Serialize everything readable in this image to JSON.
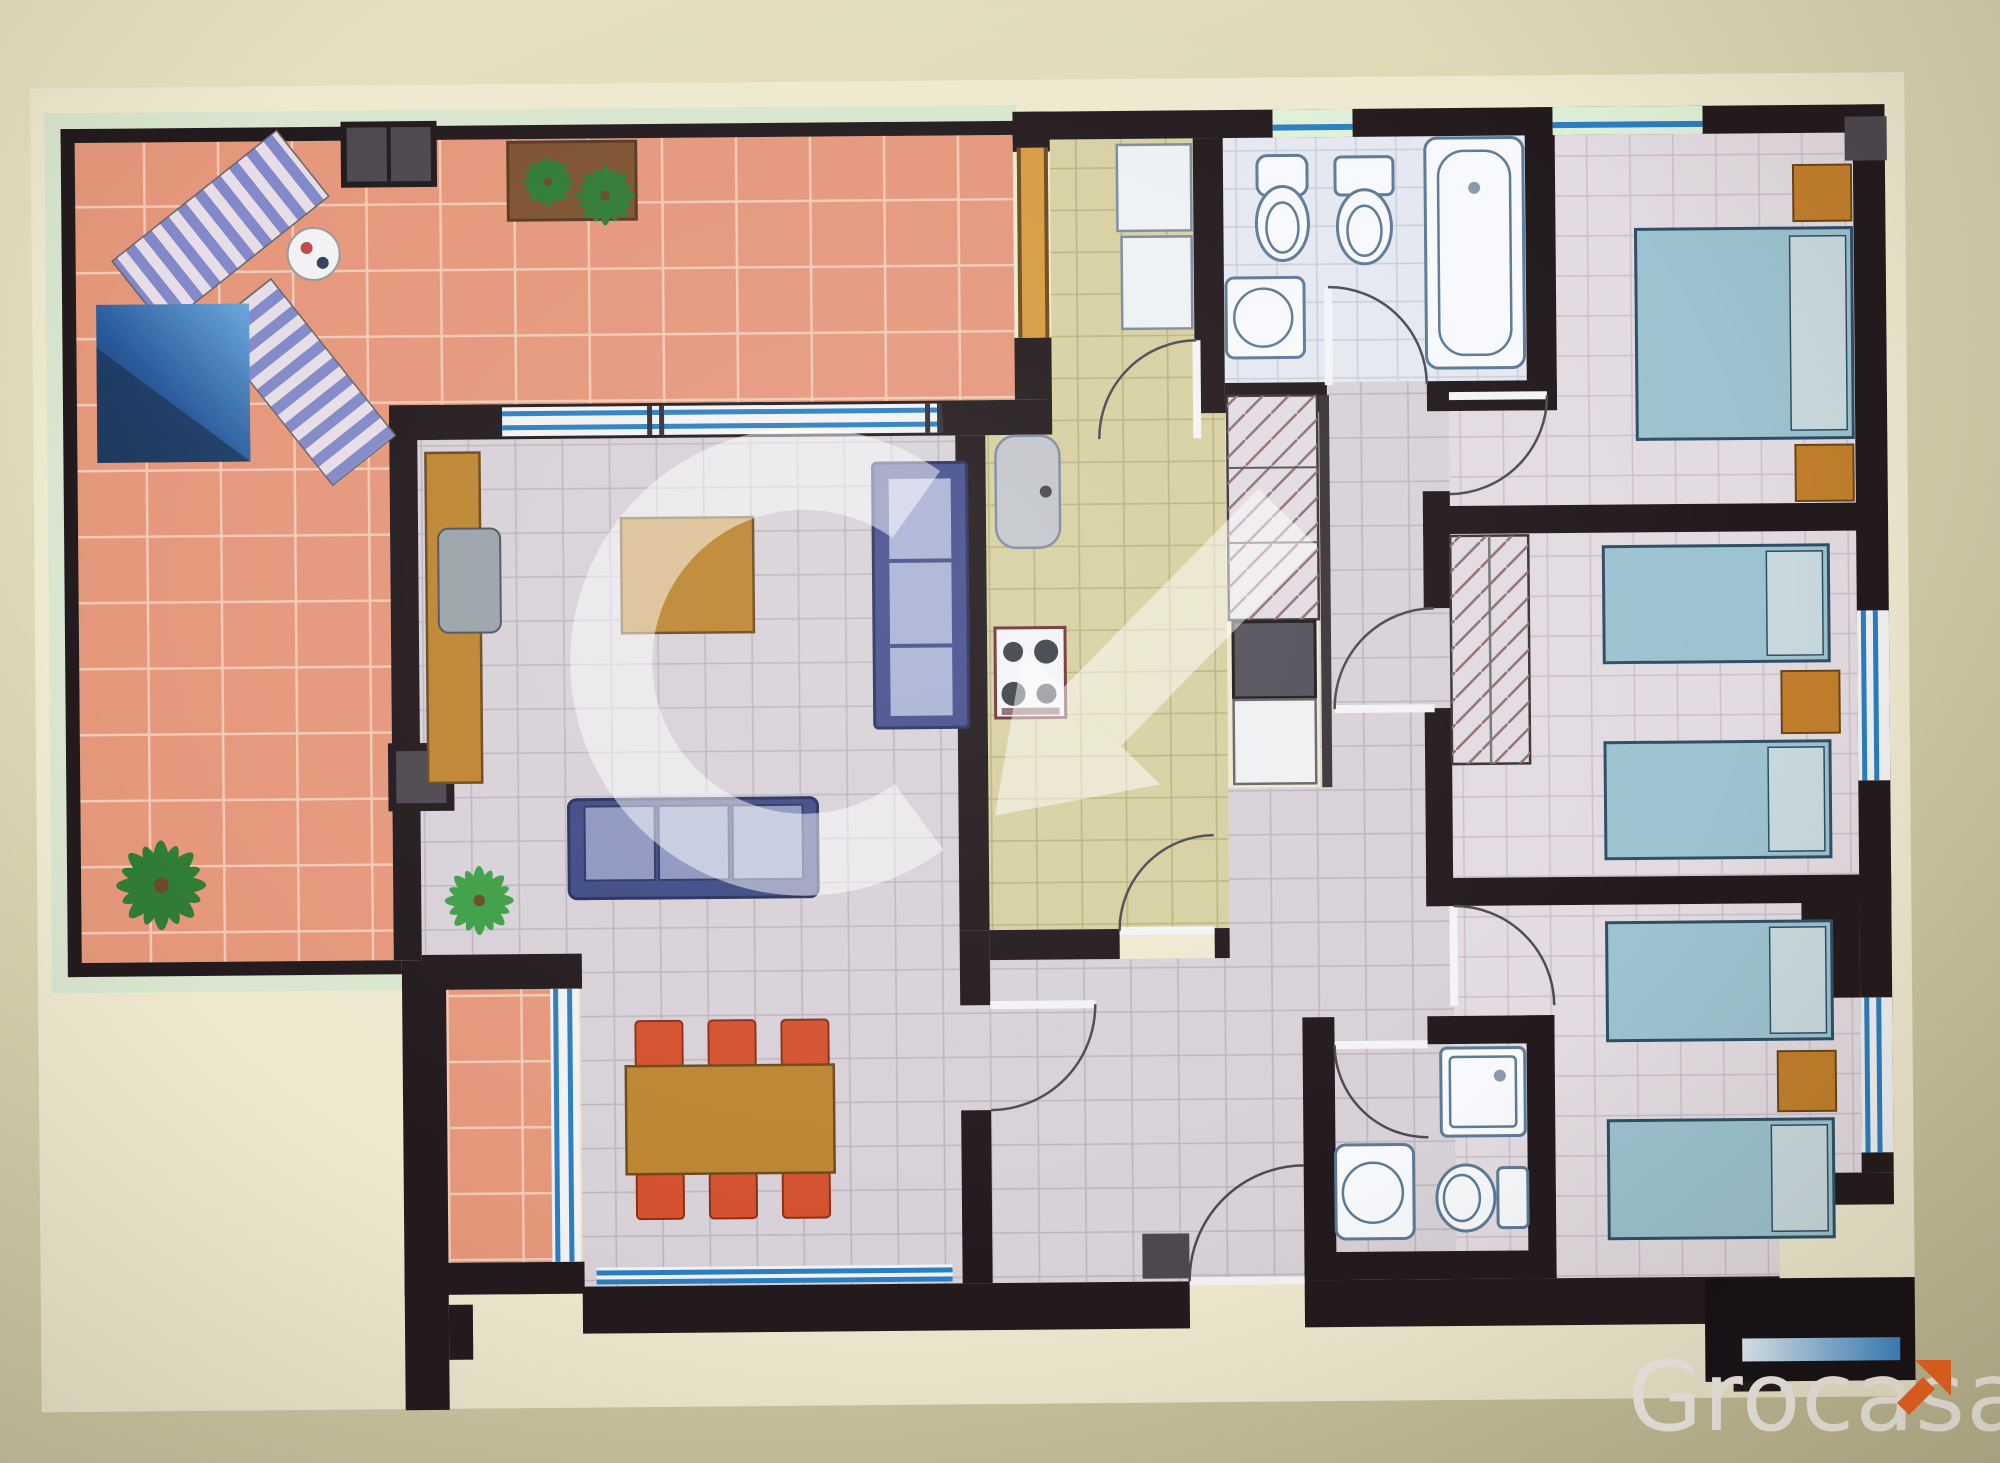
{
  "brand": {
    "name": "Grocasa"
  },
  "watermark": {
    "letter": "G",
    "opacity": 0.5
  },
  "colors": {
    "bgTop": "#e9e3c2",
    "bgBottom": "#c3bc96",
    "paper": "#eee9cf",
    "railing": "#d9e6cf",
    "wall": "#221a1d",
    "pillar": "#4d4850",
    "doorTan": "#d79b40",
    "terrace": "#e5977b",
    "terraceGrout": "#f2c9b4",
    "living": "#d8d2d8",
    "livingGrout": "#bcb5c0",
    "kitchen": "#d7d0a1",
    "kitchenGrout": "#b9b27e",
    "bath": "#e5e8f0",
    "bathGrout": "#c7cedd",
    "bedroom": "#e2dce2",
    "bedroomGrout": "#cabfca",
    "window": "#2a7ec2",
    "sill": "#dff0d8",
    "wood": "#bd8531",
    "woodDark": "#6b4a1c",
    "chair": "#d4512e",
    "chairDark": "#8a2f16",
    "sofa": "#3f4a85",
    "sofaCushion": "#8d96bf",
    "cabinet": "#454f8c",
    "cabinetCushion": "#aab3d6",
    "bed": "#9cc3cf",
    "bedBorder": "#2f4f66",
    "pillow": "#c9dade",
    "nightstand": "#c27f2c",
    "plant": "#2f7c35",
    "plantBright": "#3f9f46",
    "planter": "#7e5230",
    "loungerA": "#8289c9",
    "loungerB": "#e6dde6",
    "fixture": "#f7f9fc",
    "fixtureLine": "#5d7a96",
    "counter": "#eef1f4",
    "steel": "#7e8aa0",
    "washer": "#54505a",
    "arcLine": "#4e4a52",
    "hatchLine": "#8f6f76",
    "tv": "#9aa2ab",
    "poolLight": "#6aa8dc",
    "poolMid": "#2a5a9c",
    "poolDark": "#17304f",
    "watermark": "#ffffff",
    "seBlock": "#151016",
    "logoText": "#f3f0ea",
    "logoArrow": "#f26522"
  },
  "plan": {
    "depicted_items": [
      "sun-loungers",
      "pool-mat",
      "round-side-table",
      "planter-plants",
      "palm-plant",
      "tv-sideboard",
      "tv",
      "coffee-table",
      "shelving-unit",
      "sofa",
      "floor-plant",
      "dining-table",
      "dining-chairs",
      "kitchen-sink",
      "hob",
      "fridge",
      "worktop",
      "washing-machine",
      "bidet",
      "toilets",
      "washbasins",
      "bathtub",
      "shower",
      "wardrobes",
      "double-bed",
      "single-beds",
      "nightstands"
    ]
  }
}
